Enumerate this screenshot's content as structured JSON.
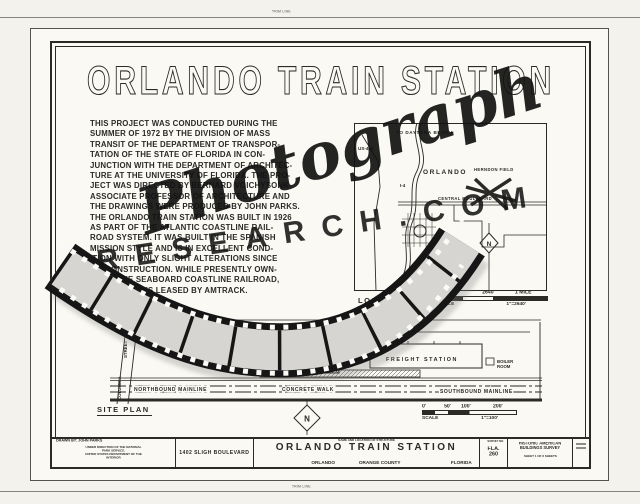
{
  "page": {
    "trim_label_top": "TRIM LINE",
    "trim_label_bottom": "TRIM LINE"
  },
  "colors": {
    "paper": "#faf9f4",
    "ink": "#2b2a26",
    "film_gray": "#d6d5d1",
    "watermark_black": "#141414"
  },
  "drawing_title": "ORLANDO TRAIN STATION",
  "description_lines": [
    "THIS PROJECT WAS CONDUCTED DURING THE",
    "SUMMER OF 1972 BY THE DIVISION OF MASS",
    "TRANSIT OF THE DEPARTMENT OF TRANSPOR-",
    "TATION OF THE STATE OF FLORIDA IN CON-",
    "JUNCTION WITH THE DEPARTMENT OF ARCHITEC-",
    "TURE AT THE UNIVERSITY OF FLORIDA. THE PRO-",
    "JECT WAS DIRECTED BY BERNARD VOICHYSONK",
    "ASSOCIATE PROFESSOR OF ARCHITECTURE AND",
    "THE DRAWINGS WERE PRODUCED BY JOHN PARKS.",
    "THE ORLANDO TRAIN STATION WAS BUILT IN 1926",
    "AS PART OF THE ATLANTIC COASTLINE RAIL-",
    "ROAD SYSTEM. IT WAS BUILT IN THE SPANISH",
    "MISSION STYLE AND IS IN EXCELLENT COND-",
    "ITION WITH ONLY SLIGHT ALTERATIONS SINCE",
    "ITS CONSTRUCTION. WHILE PRESENTLY OWN-",
    "ED BY THE SEABOARD COASTLINE RAILROAD,",
    "THE STATION IS LEASED BY AMTRACK."
  ],
  "location_map": {
    "caption": "LOCATION MAP",
    "labels": {
      "to_daytona": "TO DAYTONA BEACH",
      "us_441": "US-441",
      "orlando": "ORLANDO",
      "i_4": "I-4",
      "central_blvd": "CENTRAL BOULEVARD",
      "herndon_field": "HERNDON FIELD",
      "north": "N"
    },
    "scale": {
      "tick0": "0'",
      "tick1": "2640'",
      "tick2": "1 MILE",
      "label": "SCALE",
      "ratio": "1\"=2640'"
    }
  },
  "site_plan": {
    "caption": "SITE PLAN",
    "labels": {
      "street_word_upper": "STREET",
      "street_word_lower": "COLUMBIA",
      "sligh_blvd": "SLIGH BOULEVARD",
      "freight_station": "FREIGHT STATION",
      "boiler_line1": "BOILER",
      "boiler_line2": "ROOM",
      "northbound": "NORTHBOUND MAINLINE",
      "concrete_walk": "CONCRETE WALK",
      "southbound": "SOUTHBOUND MAINLINE",
      "north": "N"
    },
    "scale": {
      "tick0": "0'",
      "tick1": "50'",
      "tick2": "100'",
      "tick3": "200'",
      "label": "SCALE",
      "ratio": "1\"=100'"
    }
  },
  "title_block": {
    "drawn_by": "DRAWN BY: JOHN PARKS",
    "direction_lines": [
      "UNDER DIRECTION OF THE NATIONAL PARK SERVICE,",
      "UNITED STATES DEPARTMENT OF THE INTERIOR"
    ],
    "address": "1402 SLIGH BOULEVARD",
    "structure_header": "NAME AND LOCATION OF STRUCTURE",
    "structure_name": "ORLANDO TRAIN STATION",
    "city": "ORLANDO",
    "county": "ORANGE COUNTY",
    "state": "FLORIDA",
    "survey_no_header": "SURVEY NO.",
    "survey_no_lines": [
      "FLA.",
      "260"
    ],
    "survey_org_lines": [
      "HISTORIC AMERICAN",
      "BUILDINGS SURVEY"
    ],
    "sheet_info": "SHEET 1 OF 6 SHEETS"
  },
  "watermark": {
    "script_text": "Photograph",
    "caps_text": "RESEARCH.COM"
  }
}
